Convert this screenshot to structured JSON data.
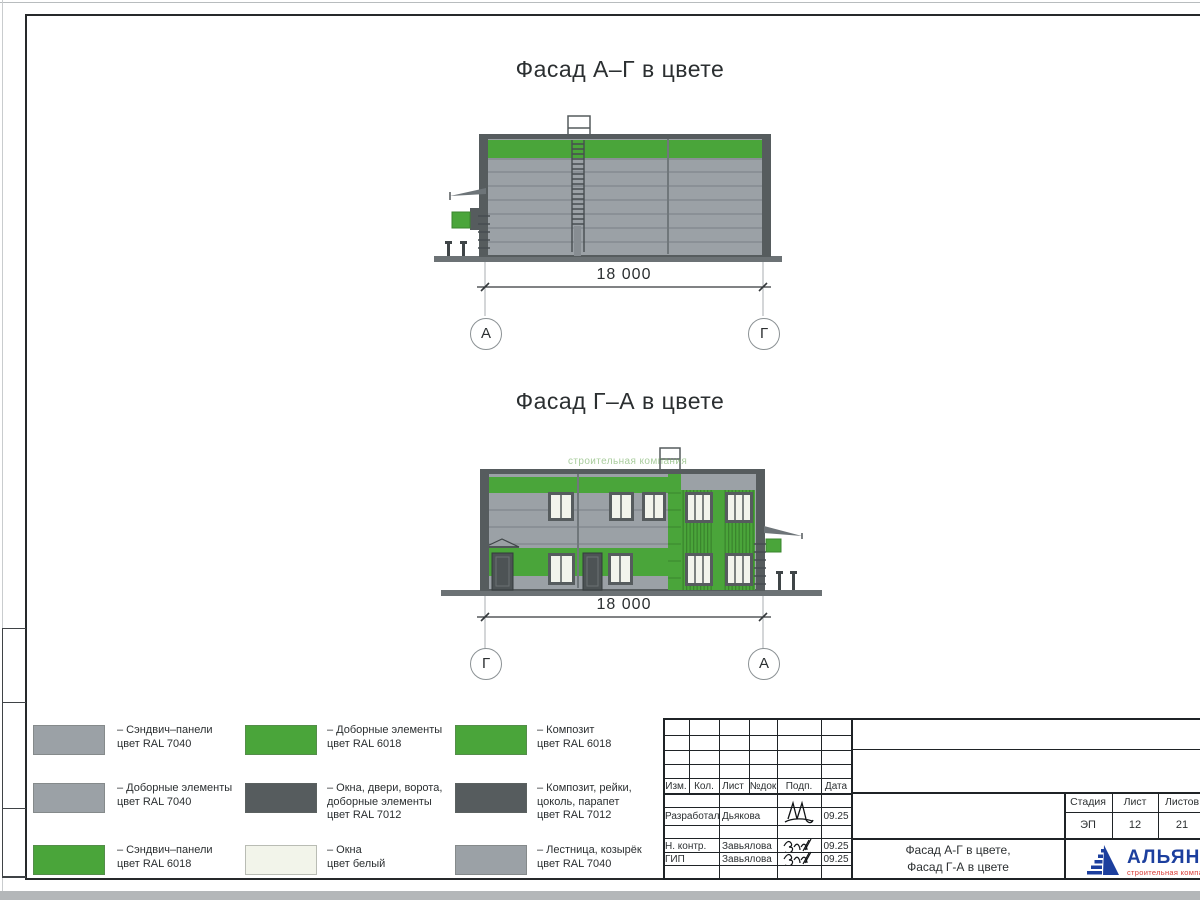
{
  "colors": {
    "ral7040": "#9ba1a6",
    "ral7040_line": "#80878c",
    "ral6018": "#4aa53a",
    "ral6018_dark": "#3a852d",
    "ral7012": "#565c5e",
    "window": "#f2f4ec",
    "ground": "#6c7275",
    "outline": "#474d50",
    "dim": "#34383b",
    "logo_blue": "#1c3f9e",
    "logo_red": "#d93a35"
  },
  "facade1": {
    "title": "Фасад А–Г в цвете",
    "dim": "18 000",
    "axis_left": "А",
    "axis_right": "Г"
  },
  "facade2": {
    "title": "Фасад Г–А в цвете",
    "dim": "18 000",
    "axis_left": "Г",
    "axis_right": "А",
    "watermark": "строительная компания"
  },
  "legend": {
    "items": [
      {
        "color": "#9ba1a6",
        "text": "– Сэндвич–панели\nцвет RAL 7040"
      },
      {
        "color": "#9ba1a6",
        "text": "– Доборные элементы\nцвет RAL 7040"
      },
      {
        "color": "#4aa53a",
        "text": "– Сэндвич–панели\nцвет RAL 6018"
      },
      {
        "color": "#4aa53a",
        "text": "– Доборные элементы\nцвет RAL 6018"
      },
      {
        "color": "#565c5e",
        "text": "– Окна, двери, ворота,\nдоборные элементы\nцвет RAL 7012"
      },
      {
        "color": "#f2f4ea",
        "text": "– Окна\nцвет белый"
      },
      {
        "color": "#4aa53a",
        "text": "– Композит\nцвет RAL 6018"
      },
      {
        "color": "#565c5e",
        "text": "– Композит, рейки,\nцоколь, парапет\nцвет RAL 7012"
      },
      {
        "color": "#9ba1a6",
        "text": "– Лестница, козырёк\nцвет RAL 7040"
      }
    ]
  },
  "titleblock": {
    "change_headers": [
      "Изм.",
      "Кол.",
      "Лист",
      "№док",
      "Подп.",
      "Дата"
    ],
    "rows": [
      {
        "role": "Разработал",
        "name": "Дьякова",
        "date": "09.25"
      },
      {
        "role": "Н. контр.",
        "name": "Завьялова",
        "date": "09.25"
      },
      {
        "role": "ГИП",
        "name": "Завьялова",
        "date": "09.25"
      }
    ],
    "doc_title_line1": "Фасад А-Г в цвете,",
    "doc_title_line2": "Фасад Г-А в цвете",
    "stage_label": "Стадия",
    "sheet_label": "Лист",
    "sheets_label": "Листов",
    "stage": "ЭП",
    "sheet": "12",
    "sheets": "21",
    "logo_text": "АЛЬЯНС",
    "logo_sub": "строительная компания"
  }
}
